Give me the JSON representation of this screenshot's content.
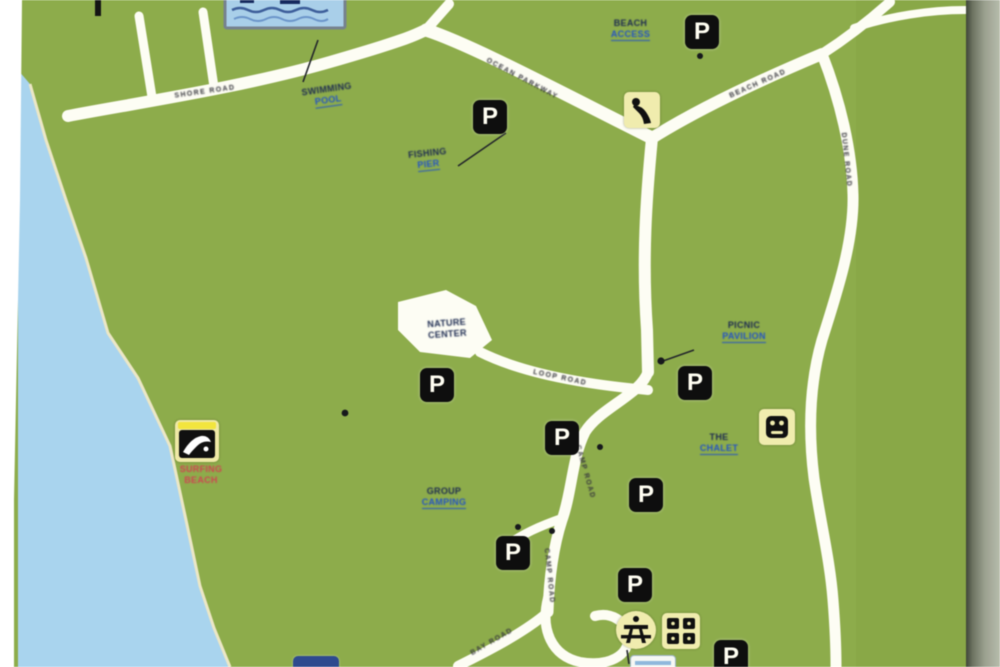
{
  "map": {
    "type": "park-trail-map",
    "labels": {
      "pool": {
        "line1": "SWIMMING",
        "line2": "POOL"
      },
      "beach_access": {
        "line1": "BEACH",
        "line2": "ACCESS"
      },
      "fishing_pier": {
        "line1": "FISHING",
        "line2": "PIER"
      },
      "nature_center": {
        "line1": "NATURE",
        "line2": "CENTER"
      },
      "picnic_pavilion": {
        "line1": "PICNIC",
        "line2": "PAVILION"
      },
      "the_chalet": {
        "line1": "THE",
        "line2": "CHALET"
      },
      "surfing_beach": {
        "line1": "SURFING",
        "line2": "BEACH"
      },
      "group_camping": {
        "line1": "GROUP",
        "line2": "CAMPING"
      }
    },
    "road_names": {
      "coast_road": "SHORE ROAD",
      "main_road": "OCEAN PARKWAY",
      "north_road": "BEACH ROAD",
      "east_road": "DUNE ROAD",
      "camp_road": "CAMP ROAD",
      "plaza_road": "LOOP ROAD",
      "south_road": "BAY ROAD"
    },
    "icons": {
      "parking_glyph": "P"
    },
    "colors": {
      "land": "#8dac4b",
      "water": "#a9d4ee",
      "road": "#fdfdf4",
      "icon_yellow": "#f0ecae",
      "icon_black": "#0e0e0e",
      "label_navy": "#1c2a50",
      "link_blue": "#2353c4",
      "label_red": "#cf4452",
      "pool_fill": "#a9cfe9",
      "edge_gray": "#9aa08f"
    }
  }
}
